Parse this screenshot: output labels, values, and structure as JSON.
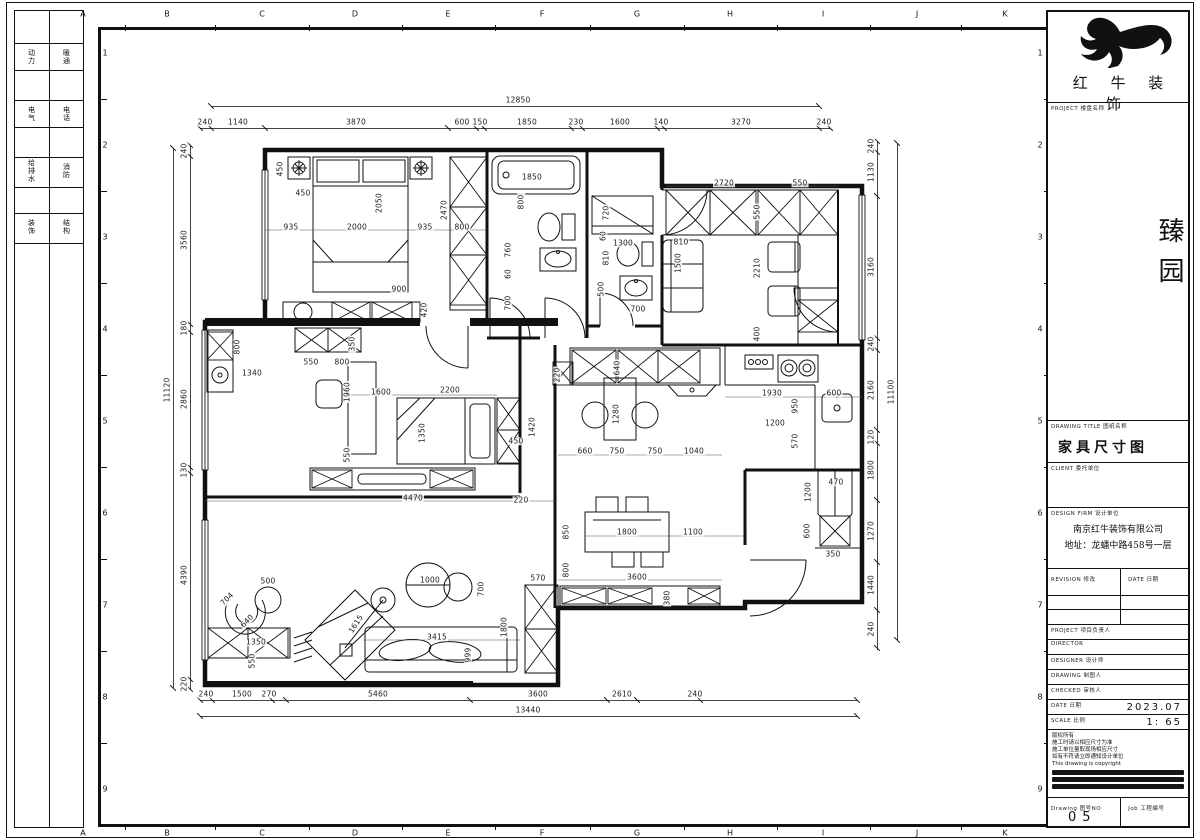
{
  "sheet": {
    "grid_letters": [
      "A",
      "B",
      "C",
      "D",
      "E",
      "F",
      "G",
      "H",
      "I",
      "J",
      "K"
    ],
    "grid_letter_x": [
      83,
      167,
      262,
      355,
      448,
      542,
      637,
      730,
      823,
      917,
      1005
    ],
    "row_numbers": [
      "1",
      "2",
      "3",
      "4",
      "5",
      "6",
      "7",
      "8",
      "9"
    ],
    "row_number_y": [
      53,
      145,
      237,
      329,
      421,
      513,
      605,
      697,
      789
    ],
    "strip_cells": [
      [
        "动力",
        "暖通"
      ],
      [
        "电气",
        "电话"
      ],
      [
        "给排水",
        "消防"
      ],
      [
        "装饰",
        "结构"
      ]
    ]
  },
  "title_block": {
    "brand": "红 牛 装 饰",
    "section_project_label": "PROJECT 楼盘名称",
    "project_name": "臻园",
    "drawing_title_label": "DRAWING TITLE 图纸名称",
    "drawing_title": "家具尺寸图",
    "client_label": "CLIENT 委托单位",
    "design_label": "DESIGN FIRM 设计单位",
    "firm": "南京红牛装饰有限公司",
    "address": "地址：龙蟠中路458号一层",
    "revision_label": "REVISION 修改",
    "rev_date_label": "DATE 日期",
    "roles": [
      "PROJECT 项目负责人",
      "DIRECTOR",
      "DESIGNER 设计师",
      "DRAWING 制图人",
      "CHECKED 审核人"
    ],
    "date_label": "DATE 日期",
    "date_value": "2023.07",
    "scale_label": "SCALE 比例",
    "scale_value": "1: 65",
    "notes": [
      "版权所有",
      "施工时请以相应尺寸为准",
      "施工单位量取现场相应尺寸",
      "如有不符请立即通知设计单位",
      "This drawing is copyright"
    ],
    "drawing_no_label": "Drawing 图号NO",
    "drawing_no": "05",
    "job_label": "Job 工程编号"
  },
  "plan": {
    "chains": [
      {
        "d": "h",
        "p": 106,
        "a": 211,
        "b": 819,
        "t": [
          211,
          819
        ],
        "l": [
          [
            "12850",
            518
          ]
        ]
      },
      {
        "d": "h",
        "p": 128,
        "a": 200,
        "b": 830,
        "t": [
          200,
          211,
          265,
          448,
          476,
          484,
          571,
          582,
          657,
          664,
          819,
          830
        ],
        "l": [
          [
            "240",
            205
          ],
          [
            "1140",
            238
          ],
          [
            "3870",
            356
          ],
          [
            "600",
            462
          ],
          [
            "150",
            480
          ],
          [
            "1850",
            527
          ],
          [
            "230",
            576
          ],
          [
            "1600",
            620
          ],
          [
            "140",
            661
          ],
          [
            "3270",
            741
          ],
          [
            "240",
            824
          ]
        ]
      },
      {
        "d": "v",
        "p": 173,
        "a": 148,
        "b": 688,
        "t": [
          148,
          688
        ],
        "l": [
          [
            "11120",
            390
          ]
        ]
      },
      {
        "d": "v",
        "p": 190,
        "a": 145,
        "b": 689,
        "t": [
          145,
          156,
          324,
          332,
          467,
          473,
          679,
          689
        ],
        "l": [
          [
            "240",
            151
          ],
          [
            "3560",
            240
          ],
          [
            "180",
            328
          ],
          [
            "2860",
            399
          ],
          [
            "130",
            470
          ],
          [
            "4390",
            575
          ],
          [
            "220",
            684
          ]
        ]
      },
      {
        "d": "v",
        "p": 877,
        "a": 141,
        "b": 650,
        "t": [
          141,
          152,
          196,
          338,
          350,
          430,
          443,
          500,
          562,
          610,
          648
        ],
        "l": [
          [
            "240",
            146
          ],
          [
            "1130",
            172
          ],
          [
            "3160",
            267
          ],
          [
            "240",
            344
          ],
          [
            "2160",
            390
          ],
          [
            "120",
            437
          ],
          [
            "1800",
            470
          ],
          [
            "1270",
            531
          ],
          [
            "1440",
            585
          ],
          [
            "240",
            629
          ]
        ]
      },
      {
        "d": "v",
        "p": 897,
        "a": 143,
        "b": 640,
        "t": [
          143,
          640
        ],
        "l": [
          [
            "11100",
            392
          ]
        ]
      },
      {
        "d": "h",
        "p": 700,
        "a": 200,
        "b": 857,
        "t": [
          200,
          212,
          272,
          286,
          470,
          607,
          637,
          700,
          857
        ],
        "l": [
          [
            "240",
            206
          ],
          [
            "1500",
            242
          ],
          [
            "270",
            269
          ],
          [
            "5460",
            378
          ],
          [
            "3600",
            538
          ],
          [
            "2610",
            622
          ],
          [
            "240",
            695
          ]
        ]
      },
      {
        "d": "h",
        "p": 716,
        "a": 200,
        "b": 857,
        "t": [
          200,
          857
        ],
        "l": [
          [
            "13440",
            528
          ]
        ]
      }
    ],
    "labels": [
      [
        "450",
        280,
        169,
        -90
      ],
      [
        "450",
        303,
        193,
        0
      ],
      [
        "2050",
        379,
        203,
        -90
      ],
      [
        "2000",
        357,
        227,
        0
      ],
      [
        "935",
        291,
        227,
        0
      ],
      [
        "935",
        425,
        227,
        0
      ],
      [
        "2470",
        444,
        210,
        -90
      ],
      [
        "800",
        462,
        227,
        0
      ],
      [
        "900",
        399,
        289,
        0
      ],
      [
        "420",
        424,
        310,
        -90
      ],
      [
        "1850",
        532,
        177,
        0
      ],
      [
        "800",
        521,
        202,
        -90
      ],
      [
        "760",
        508,
        250,
        -90
      ],
      [
        "60",
        508,
        274,
        -90
      ],
      [
        "700",
        508,
        303,
        -90
      ],
      [
        "720",
        606,
        213,
        -90
      ],
      [
        "60",
        603,
        236,
        -90
      ],
      [
        "1300",
        623,
        243,
        0
      ],
      [
        "810",
        606,
        258,
        -90
      ],
      [
        "500",
        601,
        289,
        -90
      ],
      [
        "700",
        638,
        309,
        0
      ],
      [
        "2720",
        724,
        183,
        0
      ],
      [
        "550",
        800,
        183,
        0
      ],
      [
        "550",
        757,
        212,
        -90
      ],
      [
        "810",
        681,
        242,
        0
      ],
      [
        "1500",
        678,
        263,
        -90
      ],
      [
        "2210",
        757,
        268,
        -90
      ],
      [
        "400",
        757,
        334,
        -90
      ],
      [
        "550",
        311,
        362,
        0
      ],
      [
        "800",
        342,
        362,
        0
      ],
      [
        "350",
        352,
        344,
        -90
      ],
      [
        "1960",
        347,
        392,
        -90
      ],
      [
        "1600",
        381,
        392,
        0
      ],
      [
        "2200",
        450,
        390,
        0
      ],
      [
        "1350",
        422,
        433,
        -90
      ],
      [
        "450",
        516,
        441,
        0
      ],
      [
        "1420",
        532,
        427,
        -90
      ],
      [
        "550",
        347,
        455,
        -90
      ],
      [
        "4470",
        413,
        498,
        0
      ],
      [
        "220",
        521,
        500,
        0
      ],
      [
        "800",
        237,
        347,
        -90
      ],
      [
        "1340",
        252,
        373,
        0
      ],
      [
        "220",
        557,
        375,
        -90
      ],
      [
        "640",
        617,
        368,
        -90
      ],
      [
        "1280",
        616,
        414,
        -90
      ],
      [
        "660",
        585,
        451,
        0
      ],
      [
        "750",
        617,
        451,
        0
      ],
      [
        "750",
        655,
        451,
        0
      ],
      [
        "1040",
        694,
        451,
        0
      ],
      [
        "1930",
        772,
        393,
        0
      ],
      [
        "950",
        795,
        406,
        -90
      ],
      [
        "1200",
        775,
        423,
        0
      ],
      [
        "570",
        795,
        441,
        -90
      ],
      [
        "600",
        834,
        393,
        0
      ],
      [
        "470",
        836,
        482,
        0
      ],
      [
        "1200",
        808,
        492,
        -90
      ],
      [
        "600",
        807,
        531,
        -90
      ],
      [
        "350",
        833,
        554,
        0
      ],
      [
        "850",
        566,
        532,
        -90
      ],
      [
        "1800",
        627,
        532,
        0
      ],
      [
        "1100",
        693,
        532,
        0
      ],
      [
        "800",
        566,
        570,
        -90
      ],
      [
        "3600",
        637,
        577,
        0
      ],
      [
        "380",
        667,
        598,
        -90
      ],
      [
        "500",
        268,
        581,
        0
      ],
      [
        "704",
        227,
        599,
        -45
      ],
      [
        "640",
        247,
        621,
        -45
      ],
      [
        "1350",
        256,
        642,
        0
      ],
      [
        "550",
        252,
        661,
        -90
      ],
      [
        "1615",
        356,
        624,
        -57
      ],
      [
        "3415",
        437,
        637,
        0
      ],
      [
        "999",
        468,
        655,
        -90
      ],
      [
        "1800",
        504,
        627,
        -90
      ],
      [
        "1000",
        430,
        580,
        0
      ],
      [
        "700",
        481,
        589,
        -90
      ],
      [
        "570",
        538,
        578,
        0
      ]
    ]
  }
}
